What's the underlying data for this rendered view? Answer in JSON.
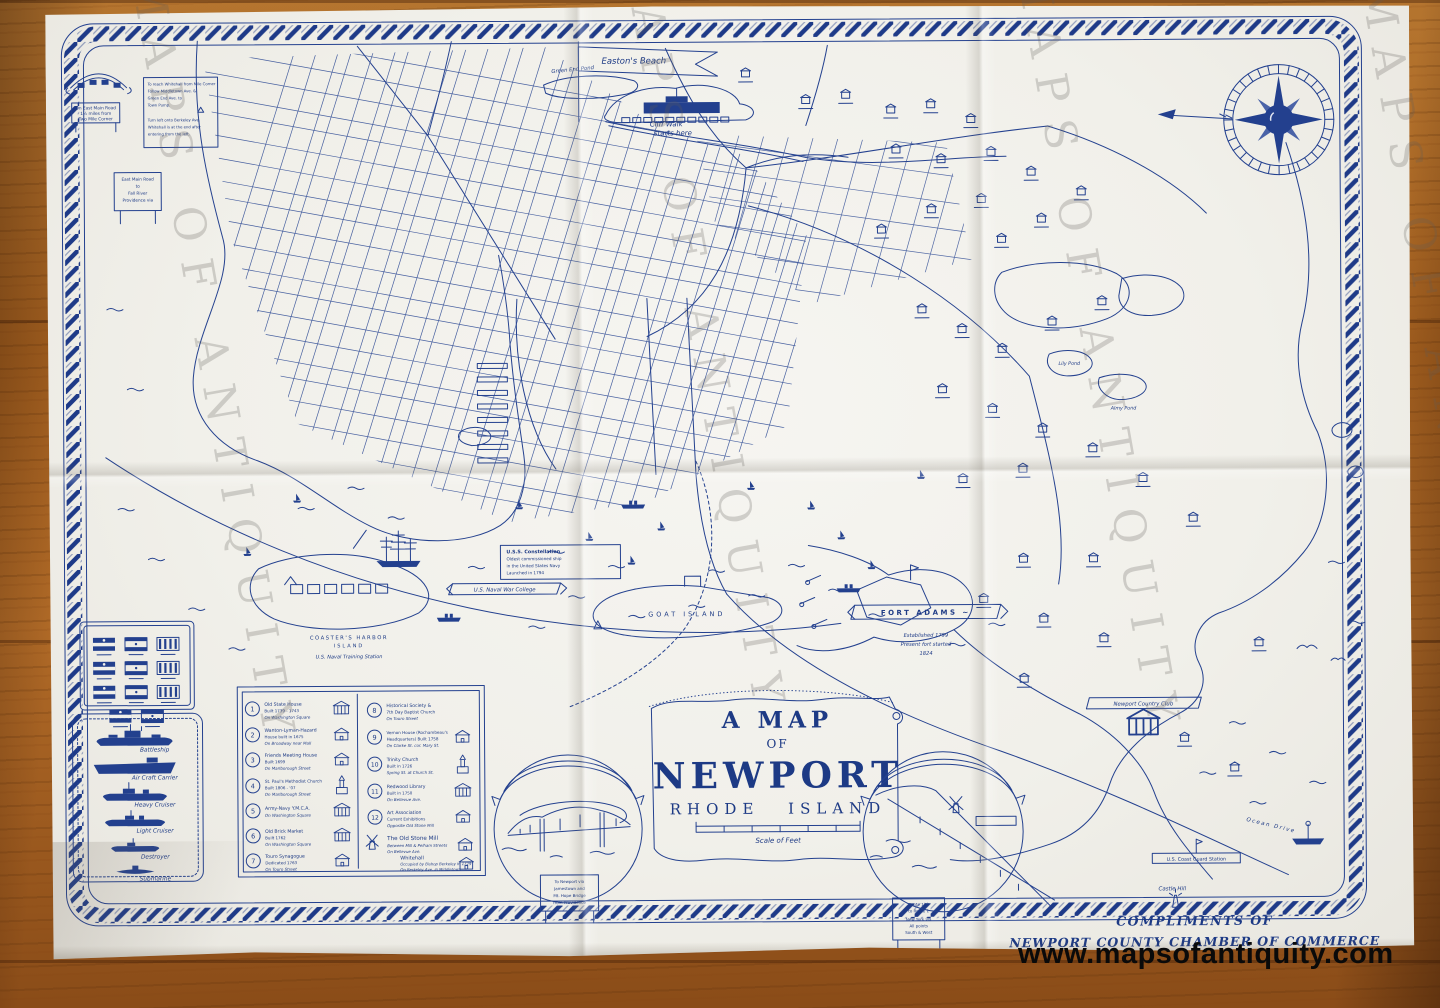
{
  "colors": {
    "ink": "#24418f",
    "paper": "#f1f0ea",
    "wood": "#a5601f",
    "url_watermark": "#0a0a0a"
  },
  "watermark": {
    "diagonal": "MAPS OF ANTIQUITY",
    "website": "www.mapsofantiquity.com"
  },
  "title": {
    "line1": "A MAP",
    "line2": "OF",
    "line3": "NEWPORT",
    "line4": "RHODE ISLAND",
    "scale": "Scale of Feet"
  },
  "compliments": {
    "line1": "COMPLIMENTS OF",
    "line2": "NEWPORT COUNTY CHAMBER OF COMMERCE"
  },
  "legend": {
    "items": [
      {
        "num": "1",
        "name": "Old State House",
        "detail": "Built 1739 - 1743",
        "location": "On Washington Square"
      },
      {
        "num": "2",
        "name": "Wanton-Lyman-Hazard",
        "detail": "House built in 1675",
        "location": "On Broadway near Mall"
      },
      {
        "num": "3",
        "name": "Friends Meeting House",
        "detail": "Built 1699",
        "location": "On Marlborough Street"
      },
      {
        "num": "4",
        "name": "St. Paul's Methodist Church",
        "detail": "Built 1806 - '07",
        "location": "On Marlborough Street"
      },
      {
        "num": "5",
        "name": "Army-Navy Y.M.C.A.",
        "detail": "",
        "location": "On Washington Square"
      },
      {
        "num": "6",
        "name": "Old Brick Market",
        "detail": "Built 1762",
        "location": "On Washington Square"
      },
      {
        "num": "7",
        "name": "Touro Synagogue",
        "detail": "Dedicated 1763",
        "location": "On Touro Street"
      },
      {
        "num": "8",
        "name": "Historical Society &",
        "detail": "7th Day Baptist Church",
        "location": "On Touro Street"
      },
      {
        "num": "9",
        "name": "Vernon House (Rochambeau's",
        "detail": "Headquarters) Built 1758",
        "location": "On Clarke St. cor. Mary St."
      },
      {
        "num": "10",
        "name": "Trinity Church",
        "detail": "Built in 1726",
        "location": "Spring St. at Church St."
      },
      {
        "num": "11",
        "name": "Redwood Library",
        "detail": "Built in 1750",
        "location": "On Bellevue Ave."
      },
      {
        "num": "12",
        "name": "Art Association",
        "detail": "Current Exhibitions",
        "location": "Opposite Old Stone Mill"
      }
    ],
    "extras": [
      {
        "name": "The Old Stone Mill",
        "detail": "Between Mill & Pelham Streets",
        "location": "On Bellevue Ave."
      },
      {
        "name": "Whitehall",
        "detail": "Occupied by Bishop Berkeley in 1729",
        "location": "On Berkeley Ave. in Middletown"
      }
    ]
  },
  "ships_key": {
    "items": [
      "Battleship",
      "Air Craft Carrier",
      "Heavy Cruiser",
      "Light Cruiser",
      "Destroyer",
      "Submarine"
    ]
  },
  "map_labels": {
    "eastons_beach": "Easton's Beach",
    "cliff_walk_1": "Cliff Walk",
    "cliff_walk_2": "starts here",
    "green_end_pond": "Green End Pond",
    "goat_island": "GOAT ISLAND",
    "constellation_1": "U.S.S. Constellation",
    "constellation_2": "Oldest commissioned ship",
    "constellation_3": "in the United States Navy",
    "constellation_4": "Launched in 1794",
    "coasters_harbor_1": "COASTER'S HARBOR",
    "coasters_harbor_2": "ISLAND",
    "coasters_harbor_3": "U.S. Naval Training Station",
    "war_college": "U.S. Naval War College",
    "fort_adams": "FORT ADAMS ~",
    "fort_adams_1": "Established 1799",
    "fort_adams_2": "Present fort started",
    "fort_adams_3": "1824",
    "lily_pond": "Lily Pond",
    "almy_pond": "Almy Pond",
    "country_club": "Newport Country Club",
    "coast_guard": "U.S. Coast Guard Station",
    "castle_hill": "Castle Hill",
    "ocean_drive": "Ocean Drive"
  },
  "signs": {
    "east_main": [
      "On East Main Road",
      "1½ miles from",
      "Two Mile Corner"
    ],
    "whitehall_note": [
      "To reach Whitehall from Mile Corner",
      "Follow Middletown Ave. &",
      "Green End Ave. to",
      "Town Pump.",
      "Turn left onto Berkeley Ave.",
      "Whitehall is at the end after",
      "entering from the left."
    ],
    "fall_river": [
      "East Main Road",
      "to",
      "Fall River",
      "Providence via"
    ],
    "bridge_sign": [
      "To Newport via",
      "Jamestown and",
      "Mt. Hope Bridge",
      "from Providence"
    ],
    "routes_sign": [
      "Route 138",
      "to Route 1",
      "New York via",
      "All points",
      "South & West"
    ]
  }
}
